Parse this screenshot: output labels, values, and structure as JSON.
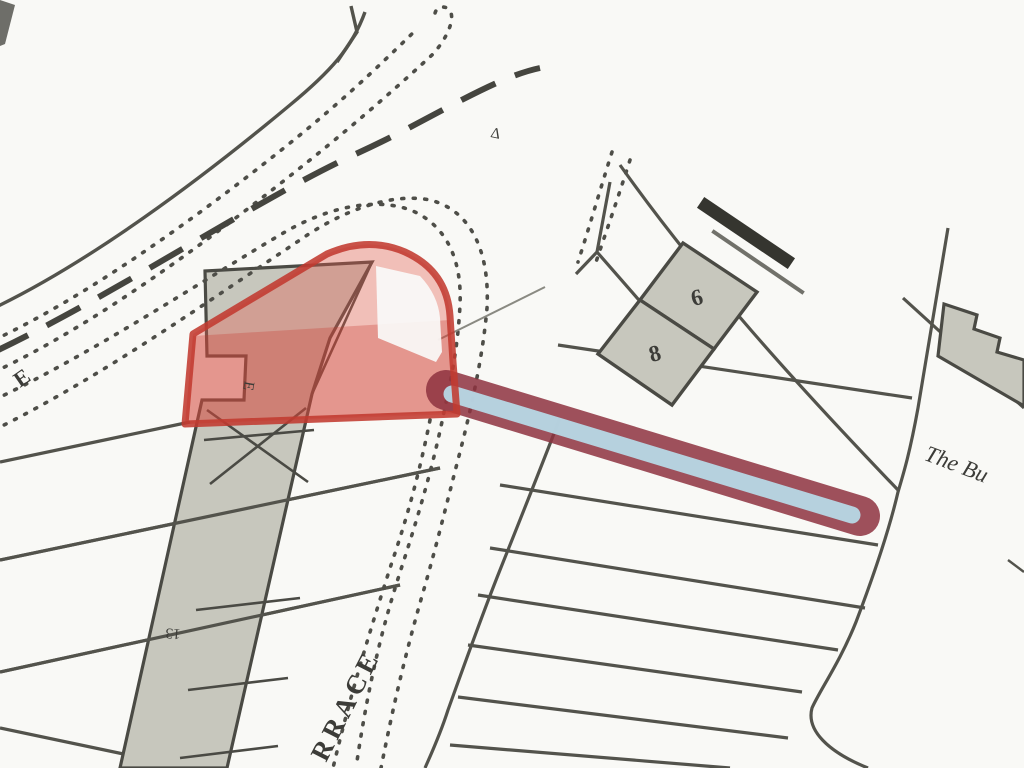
{
  "map": {
    "title": "Scanned site plan with red-edged boundary and blue access strip",
    "colors": {
      "background": "#f9f9f6",
      "line": "#53534c",
      "dotted_line": "#4e4e48",
      "dashed_boundary": "#45453f",
      "building_fill": "#c7c7bd",
      "building_stroke": "#4a4a44",
      "dark_building": "#35352f",
      "highlight_outline": "#c23a30",
      "highlight_band_fill": "rgba(228,90,74,0.36)",
      "highlight_band_dark": "rgba(198,55,48,0.30)",
      "strip_border": "#8e3340",
      "strip_fill": "#b7d8e6",
      "text": "#3c3c38"
    },
    "labels": {
      "survey_mark": "Δ",
      "road_letter": "E",
      "terrace_building_letter": "E",
      "terrace_house_number": "13",
      "street_name_fragment": "RRACE",
      "plot_number_upper": "6",
      "plot_number_lower": "8",
      "property_name_fragment": "The Bu"
    }
  }
}
